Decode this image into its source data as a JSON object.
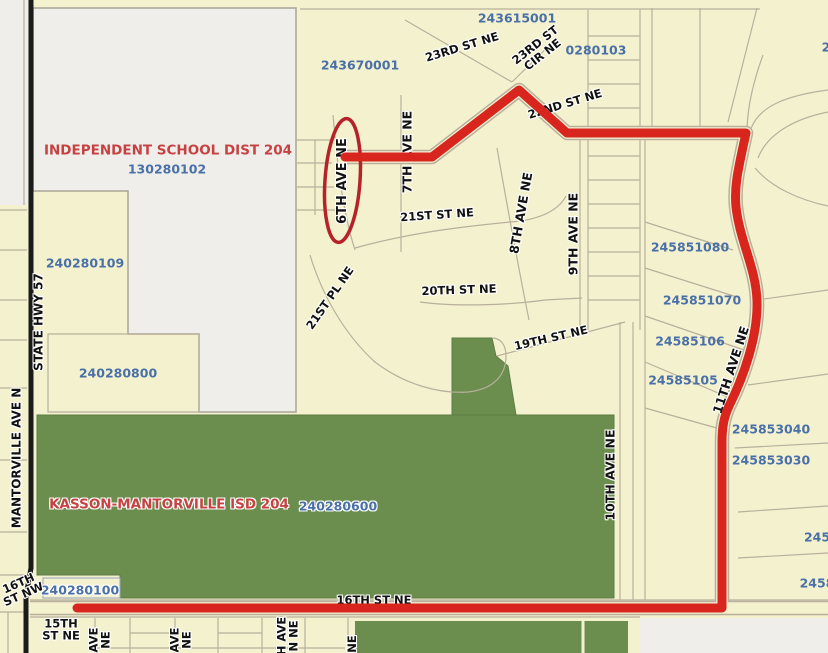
{
  "map": {
    "colors": {
      "cream": "#f4f1cf",
      "district_area": "#efeeea",
      "green": "#6b8e4e",
      "green_edge": "#5d7c43",
      "route_red": "#d8251d",
      "ellipse_red": "#b5232a",
      "road_black": "#1b1b1b",
      "parcel_line": "#b8b09c",
      "parcel_text": "#4a70a8",
      "district_text": "#c64242",
      "street_text": "#111111",
      "label_halo": "#ffffff",
      "outline_blue": "#9aa4b8"
    },
    "labels": {
      "districts": [
        {
          "name": "district-label-isd-204",
          "text": "INDEPENDENT SCHOOL DIST 204",
          "x": 168,
          "y": 151,
          "rot": 0
        },
        {
          "name": "district-label-kasson-mantorville",
          "text": "KASSON-MANTORVILLE ISD 204",
          "x": 169,
          "y": 505,
          "rot": 0,
          "halo": true
        }
      ],
      "parcels": [
        {
          "name": "parcel-label-243615001",
          "text": "243615001",
          "x": 517,
          "y": 18,
          "rot": 0
        },
        {
          "name": "parcel-label-243670001",
          "text": "243670001",
          "x": 360,
          "y": 65,
          "rot": 0
        },
        {
          "name": "parcel-label-0280103",
          "text": "0280103",
          "x": 596,
          "y": 50,
          "rot": 0
        },
        {
          "name": "parcel-label-130280102",
          "text": "130280102",
          "x": 167,
          "y": 169,
          "rot": 0
        },
        {
          "name": "parcel-label-240280109",
          "text": "240280109",
          "x": 85,
          "y": 263,
          "rot": 0
        },
        {
          "name": "parcel-label-240280800",
          "text": "240280800",
          "x": 118,
          "y": 373,
          "rot": 0
        },
        {
          "name": "parcel-label-240280600",
          "text": "240280600",
          "x": 338,
          "y": 506,
          "rot": 0,
          "halo": true
        },
        {
          "name": "parcel-label-245851080",
          "text": "245851080",
          "x": 690,
          "y": 247,
          "rot": 0
        },
        {
          "name": "parcel-label-245851070",
          "text": "245851070",
          "x": 702,
          "y": 300,
          "rot": 0
        },
        {
          "name": "parcel-label-24585106",
          "text": "24585106",
          "x": 690,
          "y": 341,
          "rot": 0
        },
        {
          "name": "parcel-label-24585105",
          "text": "24585105",
          "x": 683,
          "y": 380,
          "rot": 0
        },
        {
          "name": "parcel-label-245853040",
          "text": "245853040",
          "x": 771,
          "y": 429,
          "rot": 0
        },
        {
          "name": "parcel-label-245853030",
          "text": "245853030",
          "x": 771,
          "y": 460,
          "rot": 0
        },
        {
          "name": "parcel-label-240280100",
          "text": "240280100",
          "x": 80,
          "y": 590,
          "rot": 0,
          "halo": true
        },
        {
          "name": "parcel-label-partial-245",
          "text": "245",
          "x": 817,
          "y": 537,
          "rot": 0
        },
        {
          "name": "parcel-label-partial-2458",
          "text": "2458",
          "x": 817,
          "y": 583,
          "rot": 0
        },
        {
          "name": "parcel-label-partial-2",
          "text": "2",
          "x": 826,
          "y": 47,
          "rot": 0
        }
      ],
      "streets": [
        {
          "name": "street-label-23rd-st-ne",
          "text": "23RD ST NE",
          "x": 462,
          "y": 47,
          "rot": -17
        },
        {
          "name": "street-label-23rd-st-cir-ne",
          "text": "23RD ST\nCIR NE",
          "x": 539,
          "y": 50,
          "rot": -38
        },
        {
          "name": "street-label-22nd-st-ne",
          "text": "22ND ST NE",
          "x": 565,
          "y": 104,
          "rot": -17
        },
        {
          "name": "street-label-21st-st-ne",
          "text": "21ST ST NE",
          "x": 437,
          "y": 215,
          "rot": -4
        },
        {
          "name": "street-label-21st-pl-ne",
          "text": "21ST PL NE",
          "x": 330,
          "y": 298,
          "rot": -55
        },
        {
          "name": "street-label-20th-st-ne",
          "text": "20TH ST NE",
          "x": 459,
          "y": 290,
          "rot": -2
        },
        {
          "name": "street-label-19th-st-ne",
          "text": "19TH ST NE",
          "x": 551,
          "y": 338,
          "rot": -13
        },
        {
          "name": "street-label-6th-ave-ne",
          "text": "6TH AVE NE",
          "x": 343,
          "y": 181,
          "rot": -90,
          "size": 13
        },
        {
          "name": "street-label-7th-ave-ne",
          "text": "7TH AVE NE",
          "x": 407,
          "y": 152,
          "rot": -90,
          "size": 12.5
        },
        {
          "name": "street-label-8th-ave-ne",
          "text": "8TH AVE NE",
          "x": 521,
          "y": 213,
          "rot": -80,
          "size": 12.5
        },
        {
          "name": "street-label-9th-ave-ne",
          "text": "9TH AVE NE",
          "x": 573,
          "y": 234,
          "rot": -90,
          "size": 12.5
        },
        {
          "name": "street-label-10th-ave-ne",
          "text": "10TH AVE NE",
          "x": 610,
          "y": 475,
          "rot": -90,
          "size": 12.5
        },
        {
          "name": "street-label-11th-ave-ne",
          "text": "11TH AVE NE",
          "x": 731,
          "y": 370,
          "rot": -72,
          "size": 12.5
        },
        {
          "name": "street-label-16th-st-ne",
          "text": "16TH ST NE",
          "x": 374,
          "y": 600,
          "rot": 0
        },
        {
          "name": "street-label-16th-st-nw",
          "text": "16TH\nST NW",
          "x": 21,
          "y": 589,
          "rot": -24
        },
        {
          "name": "street-label-15th-st-ne",
          "text": "15TH\nST NE",
          "x": 61,
          "y": 630,
          "rot": 0
        },
        {
          "name": "street-label-state-hwy-57",
          "text": "STATE HWY 57",
          "x": 39,
          "y": 322,
          "rot": -90,
          "size": 12
        },
        {
          "name": "street-label-mantorville-ave-n",
          "text": "MANTORVILLE AVE N",
          "x": 17,
          "y": 458,
          "rot": -90,
          "size": 12
        },
        {
          "name": "street-label-partial-ave-ne-1",
          "text": "AVE\nNE",
          "x": 100,
          "y": 640,
          "rot": -90
        },
        {
          "name": "street-label-partial-ave-ne-2",
          "text": "AVE\nNE",
          "x": 181,
          "y": 640,
          "rot": -90
        },
        {
          "name": "street-label-partial-h-ave-n-ne",
          "text": "H AVE\nN NE",
          "x": 288,
          "y": 636,
          "rot": -90
        },
        {
          "name": "street-label-partial-ne",
          "text": "NE",
          "x": 352,
          "y": 644,
          "rot": -90
        }
      ]
    }
  }
}
